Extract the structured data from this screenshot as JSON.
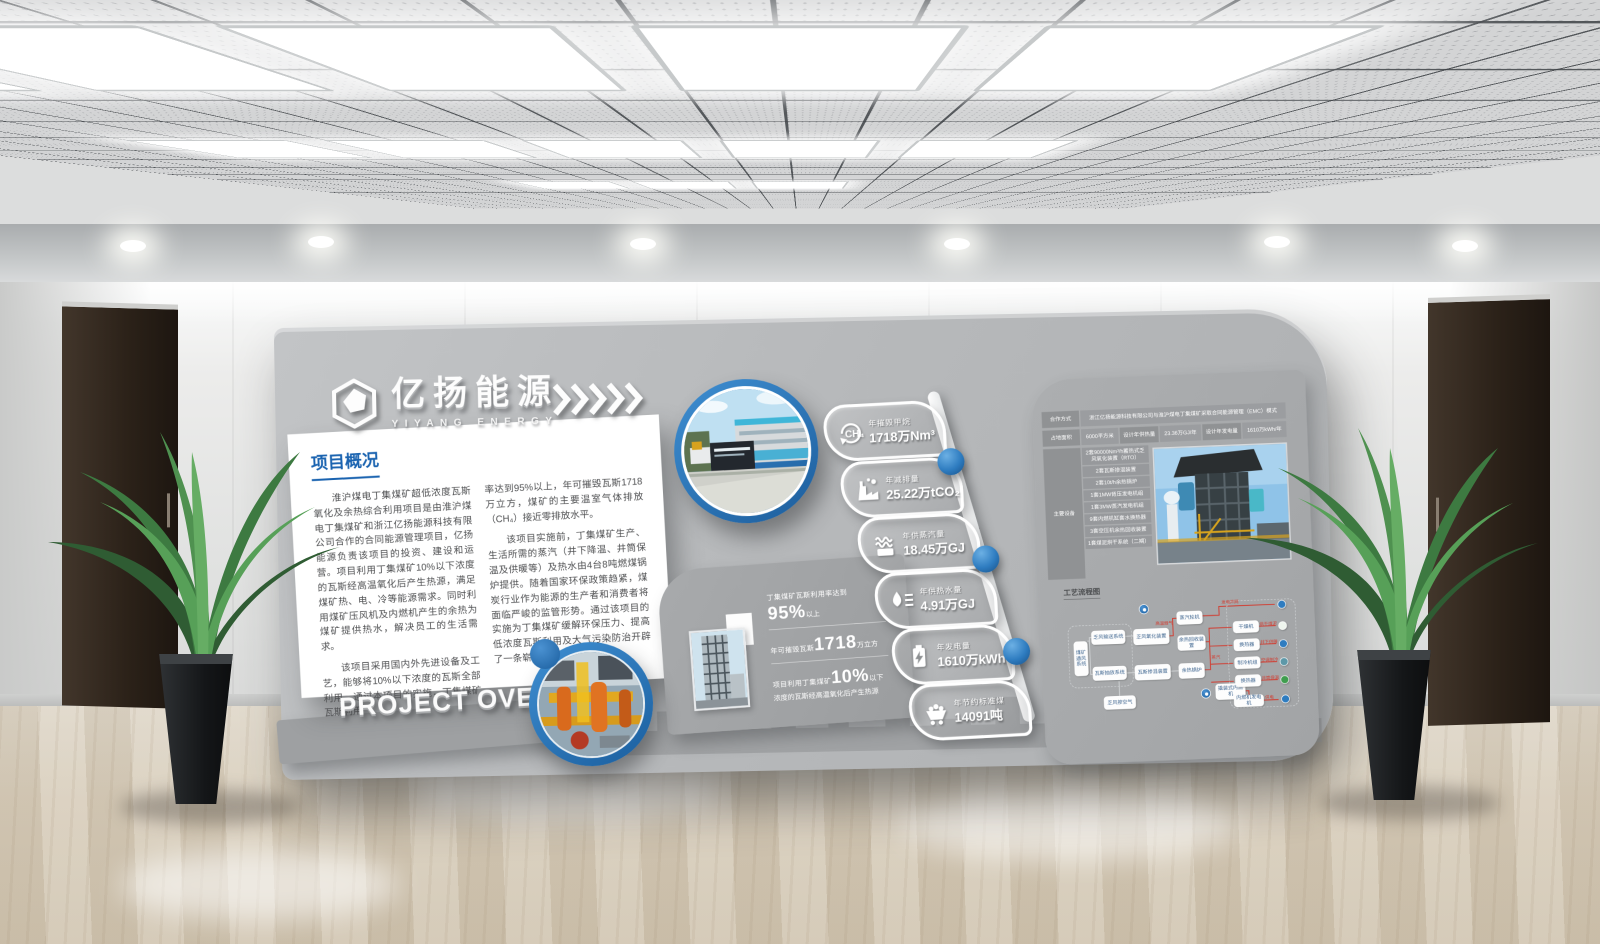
{
  "brand": {
    "name_cn": "亿扬能源",
    "name_en": "YIYANG ENERGY"
  },
  "overview": {
    "title": "项目概况",
    "p1": "淮沪煤电丁集煤矿超低浓度瓦斯氧化及余热综合利用项目是由淮沪煤电丁集煤矿和浙江亿扬能源科技有限公司合作的合同能源管理项目，亿扬能源负责该项目的投资、建设和运营。项目利用丁集煤矿10%以下浓度的瓦斯经高温氧化后产生热源，满足煤矿热、电、冷等能源需求。同时利用煤矿压风机及内燃机产生的余热为煤矿提供热水，解决员工的生活需求。",
    "p2": "该项目采用国内外先进设备及工艺，能够将10%以下浓度的瓦斯全部利用。通过本项目的实施，丁集煤矿瓦斯利用",
    "p3": "率达到95%以上，年可摧毁瓦斯1718万立方，煤矿的主要温室气体排放（CH₄）接近零排放水平。",
    "p4": "该项目实施前，丁集煤矿生产、生活所需的蒸汽（井下降温、井筒保温及供暖等）及热水由4台8吨燃煤锅炉提供。随着国家环保政策趋紧，煤炭行业作为能源的生产者和消费者将面临严峻的监管形势。通过该项目的实施为丁集煤矿缓解环保压力、提高低浓度瓦斯利用及大气污染防治开辟了一条崭新的途径。",
    "footer": "PROJECT OVERVIEW"
  },
  "stats": [
    {
      "prefix": "丁集煤矿瓦斯利用率达到",
      "big": "95%",
      "suffix": "以上"
    },
    {
      "prefix": "年可摧毁瓦斯",
      "big": "1718",
      "suffix": "万立方"
    },
    {
      "prefix": "项目利用丁集煤矿",
      "big": "10%",
      "suffix": "以下浓度的瓦斯经高温氧化后产生热源"
    }
  ],
  "badges": [
    {
      "icon": "ch4-icon",
      "icon_text": "CH₄",
      "label": "年摧毁甲烷",
      "value": "1718万Nm³"
    },
    {
      "icon": "co2-icon",
      "label": "年减排量",
      "value": "25.22万tCO₂"
    },
    {
      "icon": "steam-icon",
      "label": "年供蒸汽量",
      "value": "18.45万GJ"
    },
    {
      "icon": "hot-water-icon",
      "label": "年供热水量",
      "value": "4.91万GJ"
    },
    {
      "icon": "electricity-icon",
      "label": "年发电量",
      "value": "1610万kWh"
    },
    {
      "icon": "coal-icon",
      "label": "年节约标准煤",
      "value": "14091吨"
    }
  ],
  "info": {
    "coop_label": "合作方式",
    "coop_value": "浙江亿扬能源科技有限公司与淮沪煤电丁集煤矿采取合同能源管理（EMC）模式",
    "area_label": "占地面积",
    "area_value": "6000平方米",
    "heat_label": "设计年供热量",
    "heat_value": "23.36万GJ/年",
    "power_label": "设计年发电量",
    "power_value": "1610万kWh/年",
    "equip_label": "主要设备",
    "equipment": [
      "2套90000Nm³/h蓄热式乏风氧化装置（RTO）",
      "2套瓦斯掺混装置",
      "2套10t/h余热锅炉",
      "1套1MW背压发电机组",
      "1套3MW蒸汽发电机组",
      "9套内燃机缸套水换热器",
      "3套空压机余热回收装置",
      "1套煤泥烘干系统（二期）"
    ]
  },
  "flow": {
    "title": "工艺流程图",
    "nodes": [
      "煤矿通风系统",
      "乏风输送系统",
      "瓦斯抽放系统",
      "乏风掺空气",
      "乏风氧化装置",
      "瓦斯掺混装置",
      "余热锅炉",
      "蒸汽轮机",
      "余热回收装置",
      "撬装式内燃机",
      "干燥机",
      "换热器",
      "制冷机组",
      "换热器",
      "内燃机发电机"
    ],
    "edges": [
      "高温烟气",
      "发电并网",
      "蒸汽",
      "烘干煤泥",
      "井下供暖",
      "空调制冷",
      "井筒保温",
      "供电"
    ]
  },
  "colors": {
    "accent_blue": "#1a63b0",
    "ring_blue": "#2e7cc0",
    "line_red": "#d23b2f",
    "wall_gray": "#b9bbbd",
    "panel_gray": "#a3a5a7"
  }
}
